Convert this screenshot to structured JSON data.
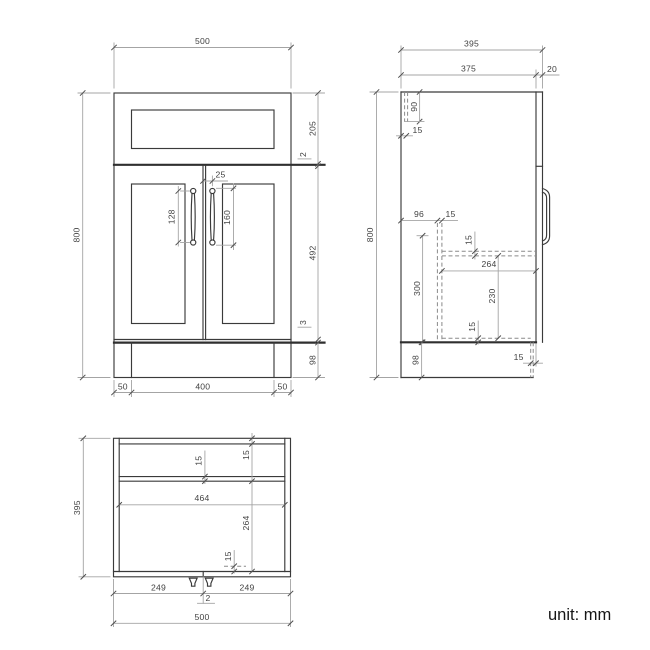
{
  "footer": {
    "unit_label": "unit: mm"
  },
  "front_view": {
    "width": "500",
    "height": "800",
    "drawer_front_height": "205",
    "drawer_gap": "2",
    "door_height": "492",
    "bottom_gap": "3",
    "plinth_height": "98",
    "handle_offset_from_center": "25",
    "handle_hole_spacing": "128",
    "handle_length": "160",
    "plinth_inset_left": "50",
    "plinth_width": "400",
    "plinth_inset_right": "50"
  },
  "side_view": {
    "depth": "395",
    "carcass_depth": "375",
    "front_thickness": "20",
    "height": "800",
    "drawer_box_height": "90",
    "back_panel_thickness": "15",
    "back_clearance": "96",
    "divider_thickness": "15",
    "interior_height": "300",
    "shelf_thickness": "15",
    "shelf_depth": "264",
    "shelf_drop": "230",
    "bottom_clearance": "15",
    "plinth_height": "98",
    "plinth_recess": "15"
  },
  "plan_view": {
    "depth": "395",
    "rail_thickness": "15",
    "back_panel_thickness": "15",
    "interior_width": "464",
    "interior_depth": "264",
    "front_clearance": "15",
    "left_door_width": "249",
    "door_gap": "2",
    "right_door_width": "249",
    "width": "500"
  }
}
